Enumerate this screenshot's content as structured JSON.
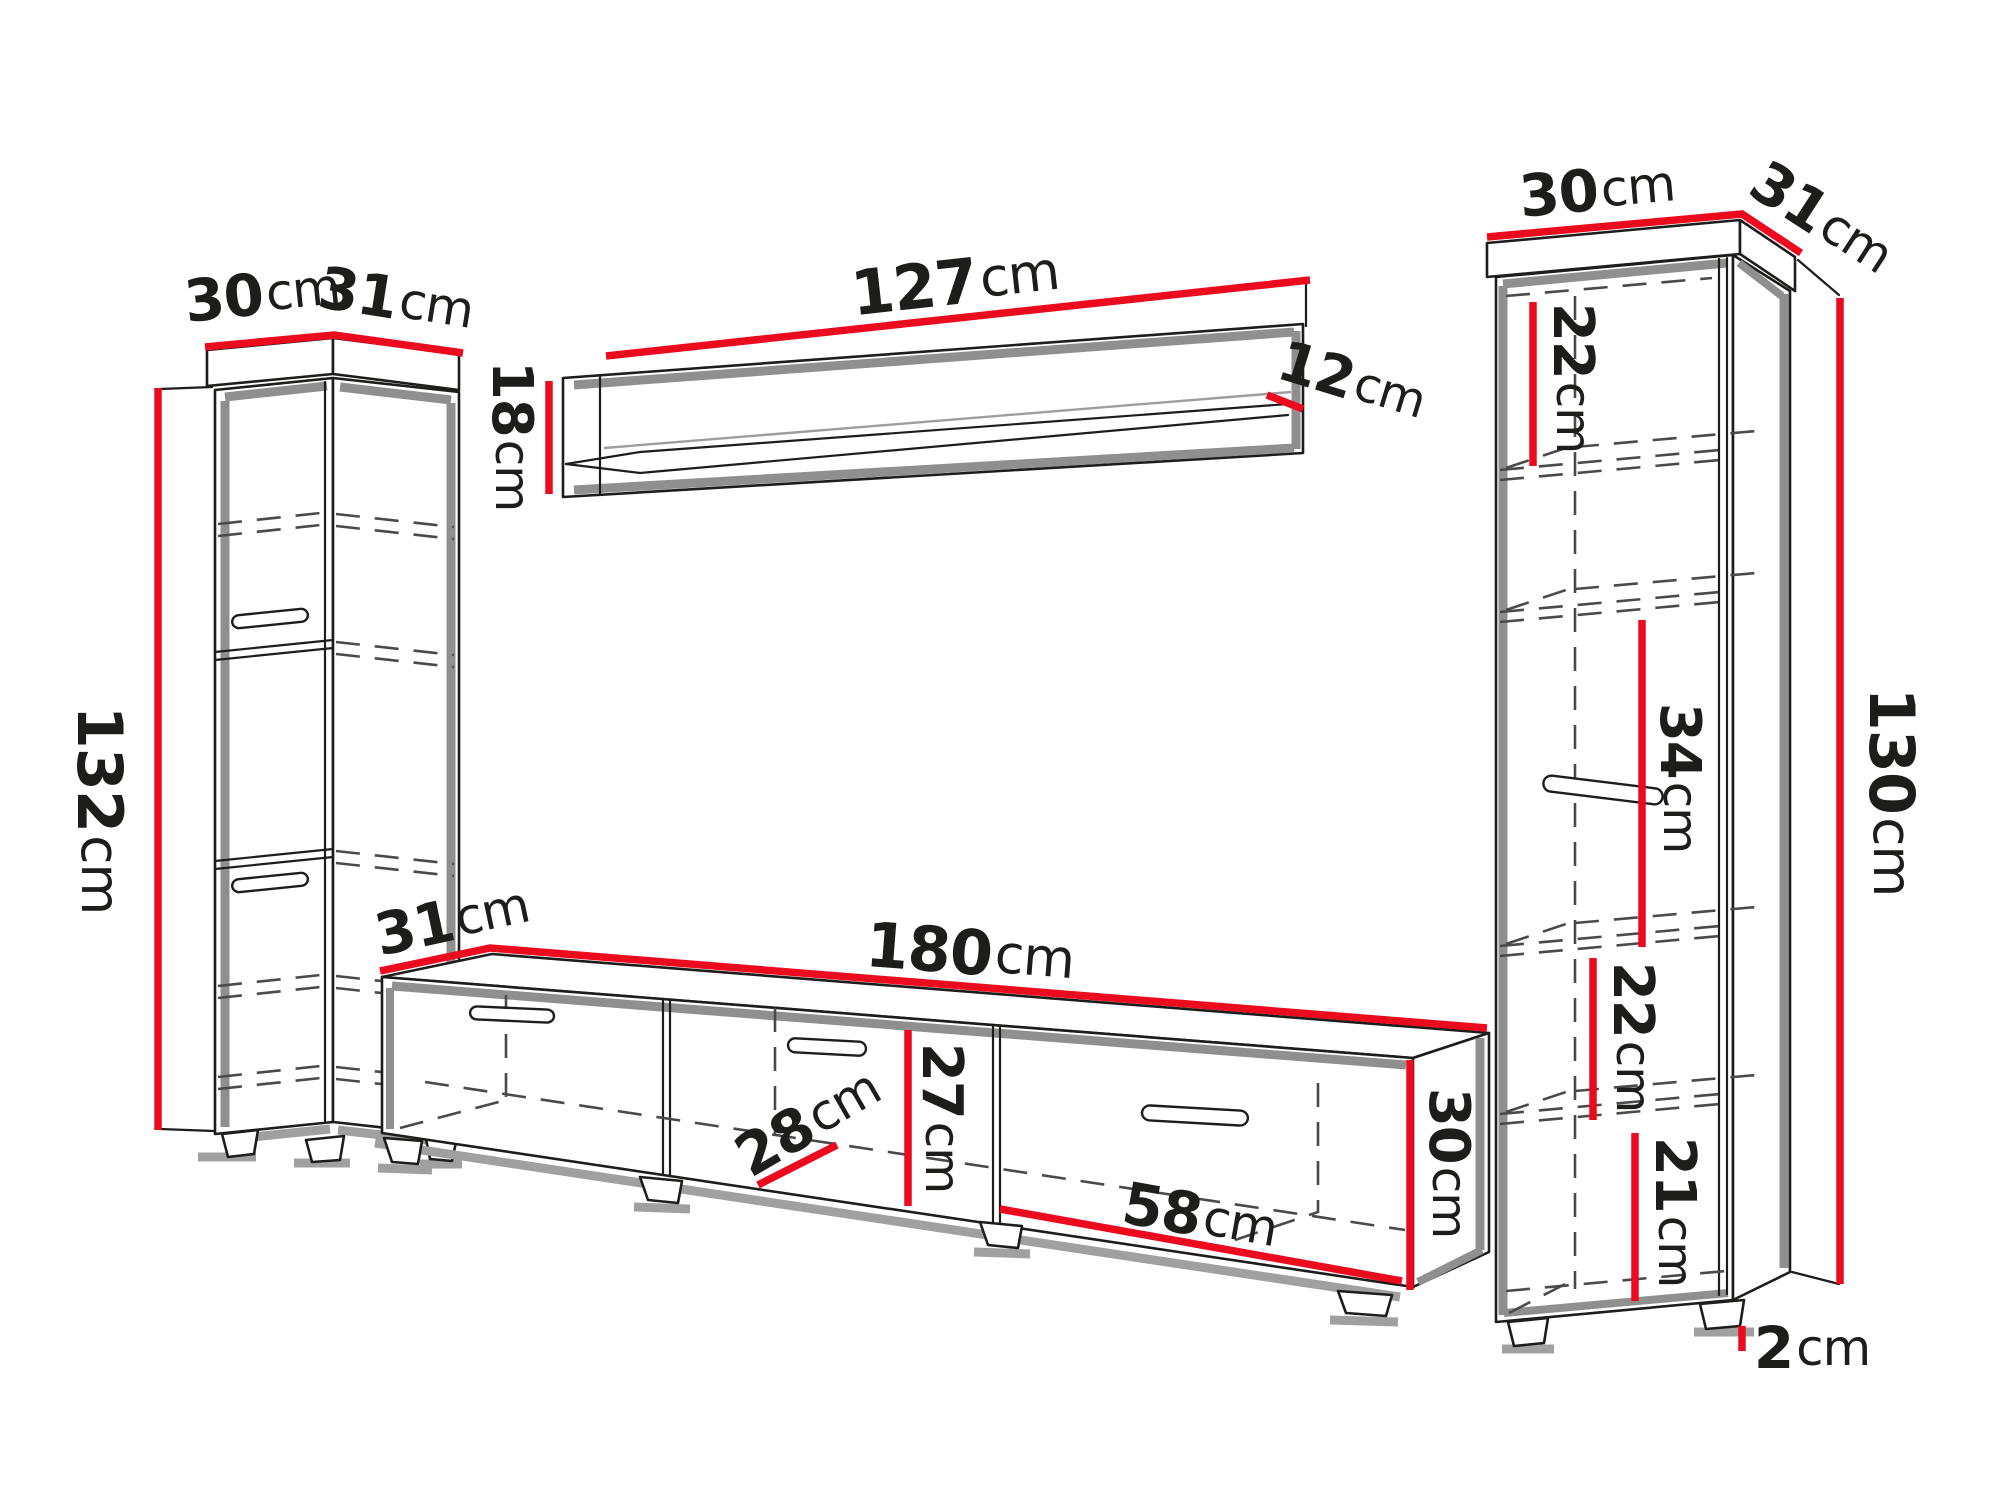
{
  "diagram": {
    "kind": "furniture-dimension-diagram",
    "units": "cm",
    "colors": {
      "dimension_line": "#ec0a1e",
      "outline": "#1d1d1b",
      "shadow": "#8f8f8f",
      "soft_shadow": "#a0a0a0",
      "dash_color": "#4a4a4a",
      "text_color": "#1d1d1b",
      "background": "#ffffff"
    },
    "components": {
      "left_cabinet": {
        "name": "Tall cabinet (left)",
        "dims": {
          "width": {
            "value": "30",
            "unit": "cm"
          },
          "depth": {
            "value": "31",
            "unit": "cm"
          },
          "height": {
            "value": "132",
            "unit": "cm"
          }
        }
      },
      "wall_shelf": {
        "name": "Wall shelf",
        "dims": {
          "width": {
            "value": "127",
            "unit": "cm"
          },
          "depth": {
            "value": "12",
            "unit": "cm"
          },
          "height": {
            "value": "18",
            "unit": "cm"
          }
        }
      },
      "tv_stand": {
        "name": "TV stand",
        "dims": {
          "depth": {
            "value": "31",
            "unit": "cm"
          },
          "width": {
            "value": "180",
            "unit": "cm"
          },
          "inner_depth": {
            "value": "28",
            "unit": "cm"
          },
          "inner_height": {
            "value": "27",
            "unit": "cm"
          },
          "compartment_width": {
            "value": "58",
            "unit": "cm"
          },
          "height": {
            "value": "30",
            "unit": "cm"
          }
        }
      },
      "right_cabinet": {
        "name": "Shelf unit (right)",
        "dims": {
          "width": {
            "value": "30",
            "unit": "cm"
          },
          "depth": {
            "value": "31",
            "unit": "cm"
          },
          "section_top": {
            "value": "22",
            "unit": "cm"
          },
          "section_middle": {
            "value": "34",
            "unit": "cm"
          },
          "section_lower": {
            "value": "22",
            "unit": "cm"
          },
          "section_bottom": {
            "value": "21",
            "unit": "cm"
          },
          "height": {
            "value": "130",
            "unit": "cm"
          },
          "plinth": {
            "value": "2",
            "unit": "cm"
          }
        }
      }
    }
  }
}
